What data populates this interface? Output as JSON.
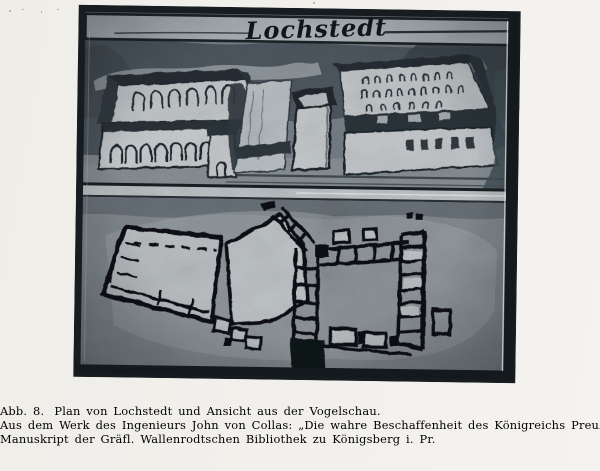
{
  "page": {
    "background": "#f1efeb"
  },
  "plate": {
    "title_script": "Lochstedt"
  },
  "caption": {
    "figure_label": "Abb. 8.",
    "title_sentence": "Plan von Lochstedt und Ansicht aus der Vogelschau.",
    "source_line": "Aus dem Werk des Ingenieurs John von Collas: „Die wahre Beschaffenheit des Königreichs Preußen“ anno 1713.",
    "manuscript_line": "Manuskript der Gräfl. Wallenrodtschen Bibliothek zu Königsberg i. Pr."
  },
  "colors": {
    "ink": "#262420",
    "photo_dark": "#1c2429",
    "photo_mid": "#7e868d",
    "photo_light": "#c7ccce",
    "title_band": "#b6bdc1"
  }
}
